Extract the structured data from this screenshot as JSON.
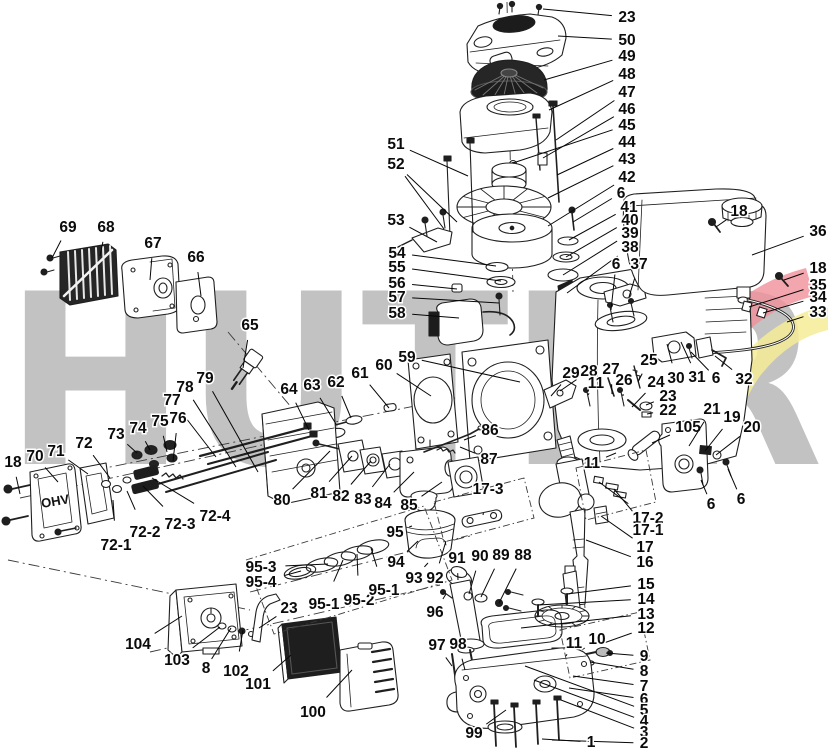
{
  "watermark": {
    "text": "HUTER",
    "letter_color": "#c2c2c2",
    "swoosh_red": "#f0909a",
    "swoosh_yellow": "#f5ec95"
  },
  "parts_text": {
    "valve_cover_marking": "OHV"
  },
  "callouts": [
    {
      "n": "23",
      "x": 627,
      "y": 17,
      "t": [
        [
          543,
          9
        ]
      ]
    },
    {
      "n": "50",
      "x": 627,
      "y": 40,
      "t": [
        [
          558,
          36
        ]
      ]
    },
    {
      "n": "49",
      "x": 627,
      "y": 56,
      "t": [
        [
          544,
          80
        ]
      ]
    },
    {
      "n": "48",
      "x": 627,
      "y": 74,
      "t": [
        [
          549,
          110
        ]
      ]
    },
    {
      "n": "47",
      "x": 627,
      "y": 92,
      "t": [
        [
          556,
          140
        ]
      ]
    },
    {
      "n": "46",
      "x": 627,
      "y": 109,
      "t": [
        [
          543,
          158
        ]
      ]
    },
    {
      "n": "45",
      "x": 627,
      "y": 125,
      "t": [
        [
          513,
          163
        ]
      ]
    },
    {
      "n": "44",
      "x": 627,
      "y": 142,
      "t": [
        [
          557,
          175
        ]
      ]
    },
    {
      "n": "43",
      "x": 627,
      "y": 159,
      "t": [
        [
          548,
          198
        ]
      ]
    },
    {
      "n": "42",
      "x": 627,
      "y": 177,
      "t": [
        [
          548,
          226
        ]
      ]
    },
    {
      "n": "6",
      "x": 621,
      "y": 193,
      "t": [
        [
          573,
          222
        ]
      ]
    },
    {
      "n": "41",
      "x": 629,
      "y": 207,
      "t": [
        [
          569,
          240
        ]
      ]
    },
    {
      "n": "40",
      "x": 630,
      "y": 220,
      "t": [
        [
          566,
          257
        ]
      ]
    },
    {
      "n": "39",
      "x": 630,
      "y": 233,
      "t": [
        [
          563,
          275
        ]
      ]
    },
    {
      "n": "38",
      "x": 630,
      "y": 247,
      "t": [
        [
          567,
          293
        ]
      ]
    },
    {
      "n": "18",
      "x": 739,
      "y": 211,
      "t": [
        [
          716,
          227
        ]
      ]
    },
    {
      "n": "36",
      "x": 818,
      "y": 231,
      "t": [
        [
          752,
          255
        ]
      ]
    },
    {
      "n": "18",
      "x": 818,
      "y": 268,
      "t": [
        [
          784,
          280
        ]
      ]
    },
    {
      "n": "35",
      "x": 818,
      "y": 285,
      "t": [
        [
          749,
          307
        ]
      ]
    },
    {
      "n": "34",
      "x": 818,
      "y": 297,
      "t": [
        [
          763,
          313
        ]
      ]
    },
    {
      "n": "33",
      "x": 818,
      "y": 312,
      "t": [
        [
          787,
          322
        ]
      ]
    },
    {
      "n": "6",
      "x": 616,
      "y": 264,
      "t": [
        [
          611,
          310
        ]
      ]
    },
    {
      "n": "37",
      "x": 639,
      "y": 264,
      "t": [
        [
          629,
          297
        ]
      ]
    },
    {
      "n": "69",
      "x": 68,
      "y": 227,
      "t": [
        [
          52,
          258
        ]
      ]
    },
    {
      "n": "68",
      "x": 106,
      "y": 227,
      "t": [
        [
          100,
          256
        ]
      ]
    },
    {
      "n": "67",
      "x": 153,
      "y": 243,
      "t": [
        [
          150,
          280
        ]
      ]
    },
    {
      "n": "66",
      "x": 196,
      "y": 257,
      "t": [
        [
          201,
          296
        ]
      ]
    },
    {
      "n": "65",
      "x": 250,
      "y": 325,
      "t": [
        [
          243,
          368
        ]
      ]
    },
    {
      "n": "51",
      "x": 396,
      "y": 144,
      "t": [
        [
          468,
          176
        ]
      ]
    },
    {
      "n": "52",
      "x": 396,
      "y": 164,
      "t": [
        [
          444,
          229
        ],
        [
          457,
          222
        ]
      ]
    },
    {
      "n": "53",
      "x": 396,
      "y": 220,
      "t": [
        [
          437,
          242
        ]
      ]
    },
    {
      "n": "54",
      "x": 397,
      "y": 253,
      "t": [
        [
          496,
          266
        ]
      ]
    },
    {
      "n": "55",
      "x": 397,
      "y": 267,
      "t": [
        [
          501,
          281
        ]
      ]
    },
    {
      "n": "56",
      "x": 397,
      "y": 283,
      "t": [
        [
          457,
          289
        ]
      ]
    },
    {
      "n": "57",
      "x": 397,
      "y": 297,
      "t": [
        [
          499,
          303
        ]
      ]
    },
    {
      "n": "58",
      "x": 397,
      "y": 313,
      "t": [
        [
          459,
          318
        ]
      ]
    },
    {
      "n": "59",
      "x": 407,
      "y": 357,
      "t": [
        [
          520,
          382
        ]
      ]
    },
    {
      "n": "60",
      "x": 384,
      "y": 365,
      "t": [
        [
          431,
          396
        ]
      ]
    },
    {
      "n": "61",
      "x": 360,
      "y": 373,
      "t": [
        [
          389,
          408
        ]
      ]
    },
    {
      "n": "62",
      "x": 336,
      "y": 382,
      "t": [
        [
          351,
          418
        ]
      ]
    },
    {
      "n": "63",
      "x": 312,
      "y": 385,
      "t": [
        [
          336,
          424
        ]
      ]
    },
    {
      "n": "64",
      "x": 289,
      "y": 389,
      "t": [
        [
          309,
          430
        ]
      ]
    },
    {
      "n": "79",
      "x": 205,
      "y": 378,
      "t": [
        [
          258,
          472
        ]
      ]
    },
    {
      "n": "78",
      "x": 185,
      "y": 387,
      "t": [
        [
          236,
          467
        ]
      ]
    },
    {
      "n": "77",
      "x": 172,
      "y": 400,
      "t": [
        [
          216,
          457
        ]
      ]
    },
    {
      "n": "76",
      "x": 178,
      "y": 418,
      "t": [
        [
          173,
          461
        ]
      ]
    },
    {
      "n": "75",
      "x": 160,
      "y": 421,
      "t": [
        [
          167,
          452
        ]
      ]
    },
    {
      "n": "74",
      "x": 138,
      "y": 428,
      "t": [
        [
          150,
          450
        ]
      ]
    },
    {
      "n": "73",
      "x": 116,
      "y": 434,
      "t": [
        [
          137,
          453
        ]
      ]
    },
    {
      "n": "72",
      "x": 84,
      "y": 443,
      "t": [
        [
          110,
          478
        ]
      ]
    },
    {
      "n": "71",
      "x": 56,
      "y": 451,
      "t": [
        [
          88,
          474
        ]
      ]
    },
    {
      "n": "70",
      "x": 35,
      "y": 456,
      "t": [
        [
          58,
          482
        ]
      ]
    },
    {
      "n": "18",
      "x": 13,
      "y": 462,
      "t": [
        [
          20,
          494
        ]
      ]
    },
    {
      "n": "72-1",
      "x": 116,
      "y": 545,
      "t": [
        [
          113,
          500
        ]
      ]
    },
    {
      "n": "72-2",
      "x": 145,
      "y": 532,
      "t": [
        [
          127,
          491
        ]
      ]
    },
    {
      "n": "72-3",
      "x": 180,
      "y": 524,
      "t": [
        [
          143,
          486
        ]
      ]
    },
    {
      "n": "72-4",
      "x": 215,
      "y": 516,
      "t": [
        [
          152,
          478
        ]
      ]
    },
    {
      "n": "80",
      "x": 282,
      "y": 500,
      "t": [
        [
          330,
          451
        ]
      ]
    },
    {
      "n": "81",
      "x": 319,
      "y": 493,
      "t": [
        [
          352,
          456
        ]
      ]
    },
    {
      "n": "82",
      "x": 341,
      "y": 496,
      "t": [
        [
          371,
          461
        ]
      ]
    },
    {
      "n": "83",
      "x": 363,
      "y": 499,
      "t": [
        [
          390,
          464
        ]
      ]
    },
    {
      "n": "84",
      "x": 383,
      "y": 503,
      "t": [
        [
          414,
          472
        ]
      ]
    },
    {
      "n": "85",
      "x": 409,
      "y": 505,
      "t": [
        [
          442,
          482
        ]
      ]
    },
    {
      "n": "86",
      "x": 490,
      "y": 430,
      "t": [
        [
          464,
          440
        ]
      ]
    },
    {
      "n": "87",
      "x": 489,
      "y": 459,
      "t": [
        [
          460,
          447
        ]
      ]
    },
    {
      "n": "17-3",
      "x": 488,
      "y": 489,
      "t": [
        [
          483,
          515
        ]
      ]
    },
    {
      "n": "29",
      "x": 571,
      "y": 373,
      "t": [
        [
          551,
          396
        ]
      ]
    },
    {
      "n": "28",
      "x": 589,
      "y": 371,
      "t": [
        [
          560,
          391
        ]
      ]
    },
    {
      "n": "27",
      "x": 611,
      "y": 369,
      "t": [
        [
          612,
          394
        ]
      ]
    },
    {
      "n": "11",
      "x": 596,
      "y": 383,
      "t": [
        [
          588,
          395
        ]
      ]
    },
    {
      "n": "26",
      "x": 624,
      "y": 380,
      "t": [
        [
          623,
          396
        ]
      ]
    },
    {
      "n": "25",
      "x": 649,
      "y": 360,
      "t": [
        [
          638,
          382
        ]
      ]
    },
    {
      "n": "24",
      "x": 656,
      "y": 382,
      "t": [
        [
          632,
          407
        ]
      ]
    },
    {
      "n": "23",
      "x": 668,
      "y": 396,
      "t": [
        [
          646,
          405
        ]
      ]
    },
    {
      "n": "22",
      "x": 668,
      "y": 410,
      "t": [
        [
          647,
          414
        ]
      ]
    },
    {
      "n": "30",
      "x": 676,
      "y": 378,
      "t": [
        [
          667,
          344
        ]
      ]
    },
    {
      "n": "31",
      "x": 697,
      "y": 377,
      "t": [
        [
          681,
          342
        ]
      ]
    },
    {
      "n": "6",
      "x": 716,
      "y": 378,
      "t": [
        [
          691,
          352
        ]
      ]
    },
    {
      "n": "32",
      "x": 744,
      "y": 379,
      "t": [
        [
          715,
          356
        ]
      ]
    },
    {
      "n": "105",
      "x": 688,
      "y": 427,
      "t": [
        [
          652,
          443
        ]
      ]
    },
    {
      "n": "21",
      "x": 712,
      "y": 409,
      "t": [
        [
          689,
          446
        ]
      ]
    },
    {
      "n": "19",
      "x": 732,
      "y": 417,
      "t": [
        [
          705,
          451
        ]
      ]
    },
    {
      "n": "20",
      "x": 752,
      "y": 427,
      "t": [
        [
          716,
          455
        ]
      ]
    },
    {
      "n": "11",
      "x": 592,
      "y": 463,
      "t": [
        [
          616,
          453
        ]
      ]
    },
    {
      "n": "6",
      "x": 711,
      "y": 504,
      "t": [
        [
          701,
          480
        ]
      ]
    },
    {
      "n": "6",
      "x": 741,
      "y": 499,
      "t": [
        [
          728,
          469
        ]
      ]
    },
    {
      "n": "17-2",
      "x": 648,
      "y": 518,
      "t": [
        [
          599,
          482
        ]
      ]
    },
    {
      "n": "17-1",
      "x": 648,
      "y": 530,
      "t": [
        [
          614,
          489
        ]
      ]
    },
    {
      "n": "17",
      "x": 645,
      "y": 547,
      "t": [
        [
          601,
          516
        ]
      ]
    },
    {
      "n": "16",
      "x": 645,
      "y": 562,
      "t": [
        [
          586,
          540
        ]
      ]
    },
    {
      "n": "15",
      "x": 646,
      "y": 584,
      "t": [
        [
          567,
          594
        ]
      ]
    },
    {
      "n": "14",
      "x": 646,
      "y": 599,
      "t": [
        [
          538,
          605
        ]
      ]
    },
    {
      "n": "13",
      "x": 646,
      "y": 614,
      "t": [
        [
          521,
          628
        ]
      ]
    },
    {
      "n": "12",
      "x": 646,
      "y": 628,
      "t": [
        [
          601,
          644
        ]
      ]
    },
    {
      "n": "9",
      "x": 644,
      "y": 656,
      "t": [
        [
          606,
          653
        ]
      ]
    },
    {
      "n": "8",
      "x": 644,
      "y": 671,
      "t": [
        [
          590,
          662
        ]
      ]
    },
    {
      "n": "7",
      "x": 644,
      "y": 686,
      "t": [
        [
          573,
          676
        ]
      ]
    },
    {
      "n": "6",
      "x": 644,
      "y": 699,
      "t": [
        [
          569,
          688
        ]
      ]
    },
    {
      "n": "5",
      "x": 644,
      "y": 710,
      "t": [
        [
          525,
          666
        ]
      ]
    },
    {
      "n": "4",
      "x": 644,
      "y": 721,
      "t": [
        [
          534,
          680
        ]
      ]
    },
    {
      "n": "3",
      "x": 644,
      "y": 732,
      "t": [
        [
          561,
          700
        ]
      ]
    },
    {
      "n": "2",
      "x": 644,
      "y": 743,
      "t": [
        [
          552,
          740
        ]
      ]
    },
    {
      "n": "1",
      "x": 591,
      "y": 742,
      "t": [
        [
          542,
          739
        ]
      ]
    },
    {
      "n": "10",
      "x": 597,
      "y": 639,
      "t": [
        [
          582,
          650
        ]
      ]
    },
    {
      "n": "11",
      "x": 574,
      "y": 643,
      "t": [
        [
          566,
          656
        ]
      ]
    },
    {
      "n": "95",
      "x": 395,
      "y": 532,
      "t": [
        [
          412,
          526
        ]
      ]
    },
    {
      "n": "94",
      "x": 396,
      "y": 562,
      "t": [
        [
          418,
          541
        ]
      ]
    },
    {
      "n": "93",
      "x": 414,
      "y": 578,
      "t": [
        [
          428,
          563
        ]
      ]
    },
    {
      "n": "92",
      "x": 435,
      "y": 578,
      "t": [
        [
          446,
          541
        ]
      ]
    },
    {
      "n": "91",
      "x": 457,
      "y": 558,
      "t": [
        [
          458,
          580
        ]
      ]
    },
    {
      "n": "90",
      "x": 480,
      "y": 556,
      "t": [
        [
          469,
          594
        ]
      ]
    },
    {
      "n": "89",
      "x": 501,
      "y": 555,
      "t": [
        [
          481,
          597
        ]
      ]
    },
    {
      "n": "88",
      "x": 523,
      "y": 555,
      "t": [
        [
          499,
          603
        ]
      ]
    },
    {
      "n": "96",
      "x": 435,
      "y": 612,
      "t": [
        [
          446,
          594
        ]
      ]
    },
    {
      "n": "97",
      "x": 437,
      "y": 645,
      "t": [
        [
          452,
          666
        ]
      ]
    },
    {
      "n": "98",
      "x": 458,
      "y": 644,
      "t": [
        [
          465,
          670
        ]
      ]
    },
    {
      "n": "99",
      "x": 474,
      "y": 733,
      "t": [
        [
          506,
          710
        ]
      ]
    },
    {
      "n": "95-3",
      "x": 261,
      "y": 567,
      "t": [
        [
          328,
          564
        ]
      ]
    },
    {
      "n": "95-4",
      "x": 261,
      "y": 582,
      "t": [
        [
          301,
          571
        ]
      ]
    },
    {
      "n": "95-1",
      "x": 324,
      "y": 604,
      "t": [
        [
          343,
          560
        ]
      ]
    },
    {
      "n": "95-2",
      "x": 359,
      "y": 600,
      "t": [
        [
          357,
          554
        ]
      ]
    },
    {
      "n": "95-1",
      "x": 384,
      "y": 590,
      "t": [
        [
          371,
          548
        ]
      ]
    },
    {
      "n": "23",
      "x": 289,
      "y": 608,
      "t": [
        [
          259,
          628
        ]
      ]
    },
    {
      "n": "104",
      "x": 138,
      "y": 644,
      "t": [
        [
          182,
          616
        ]
      ]
    },
    {
      "n": "103",
      "x": 177,
      "y": 660,
      "t": [
        [
          220,
          627
        ]
      ]
    },
    {
      "n": "8",
      "x": 206,
      "y": 668,
      "t": [
        [
          231,
          628
        ]
      ]
    },
    {
      "n": "102",
      "x": 236,
      "y": 671,
      "t": [
        [
          243,
          630
        ]
      ]
    },
    {
      "n": "101",
      "x": 258,
      "y": 684,
      "t": [
        [
          291,
          655
        ]
      ]
    },
    {
      "n": "100",
      "x": 313,
      "y": 712,
      "t": [
        [
          352,
          670
        ]
      ]
    }
  ]
}
